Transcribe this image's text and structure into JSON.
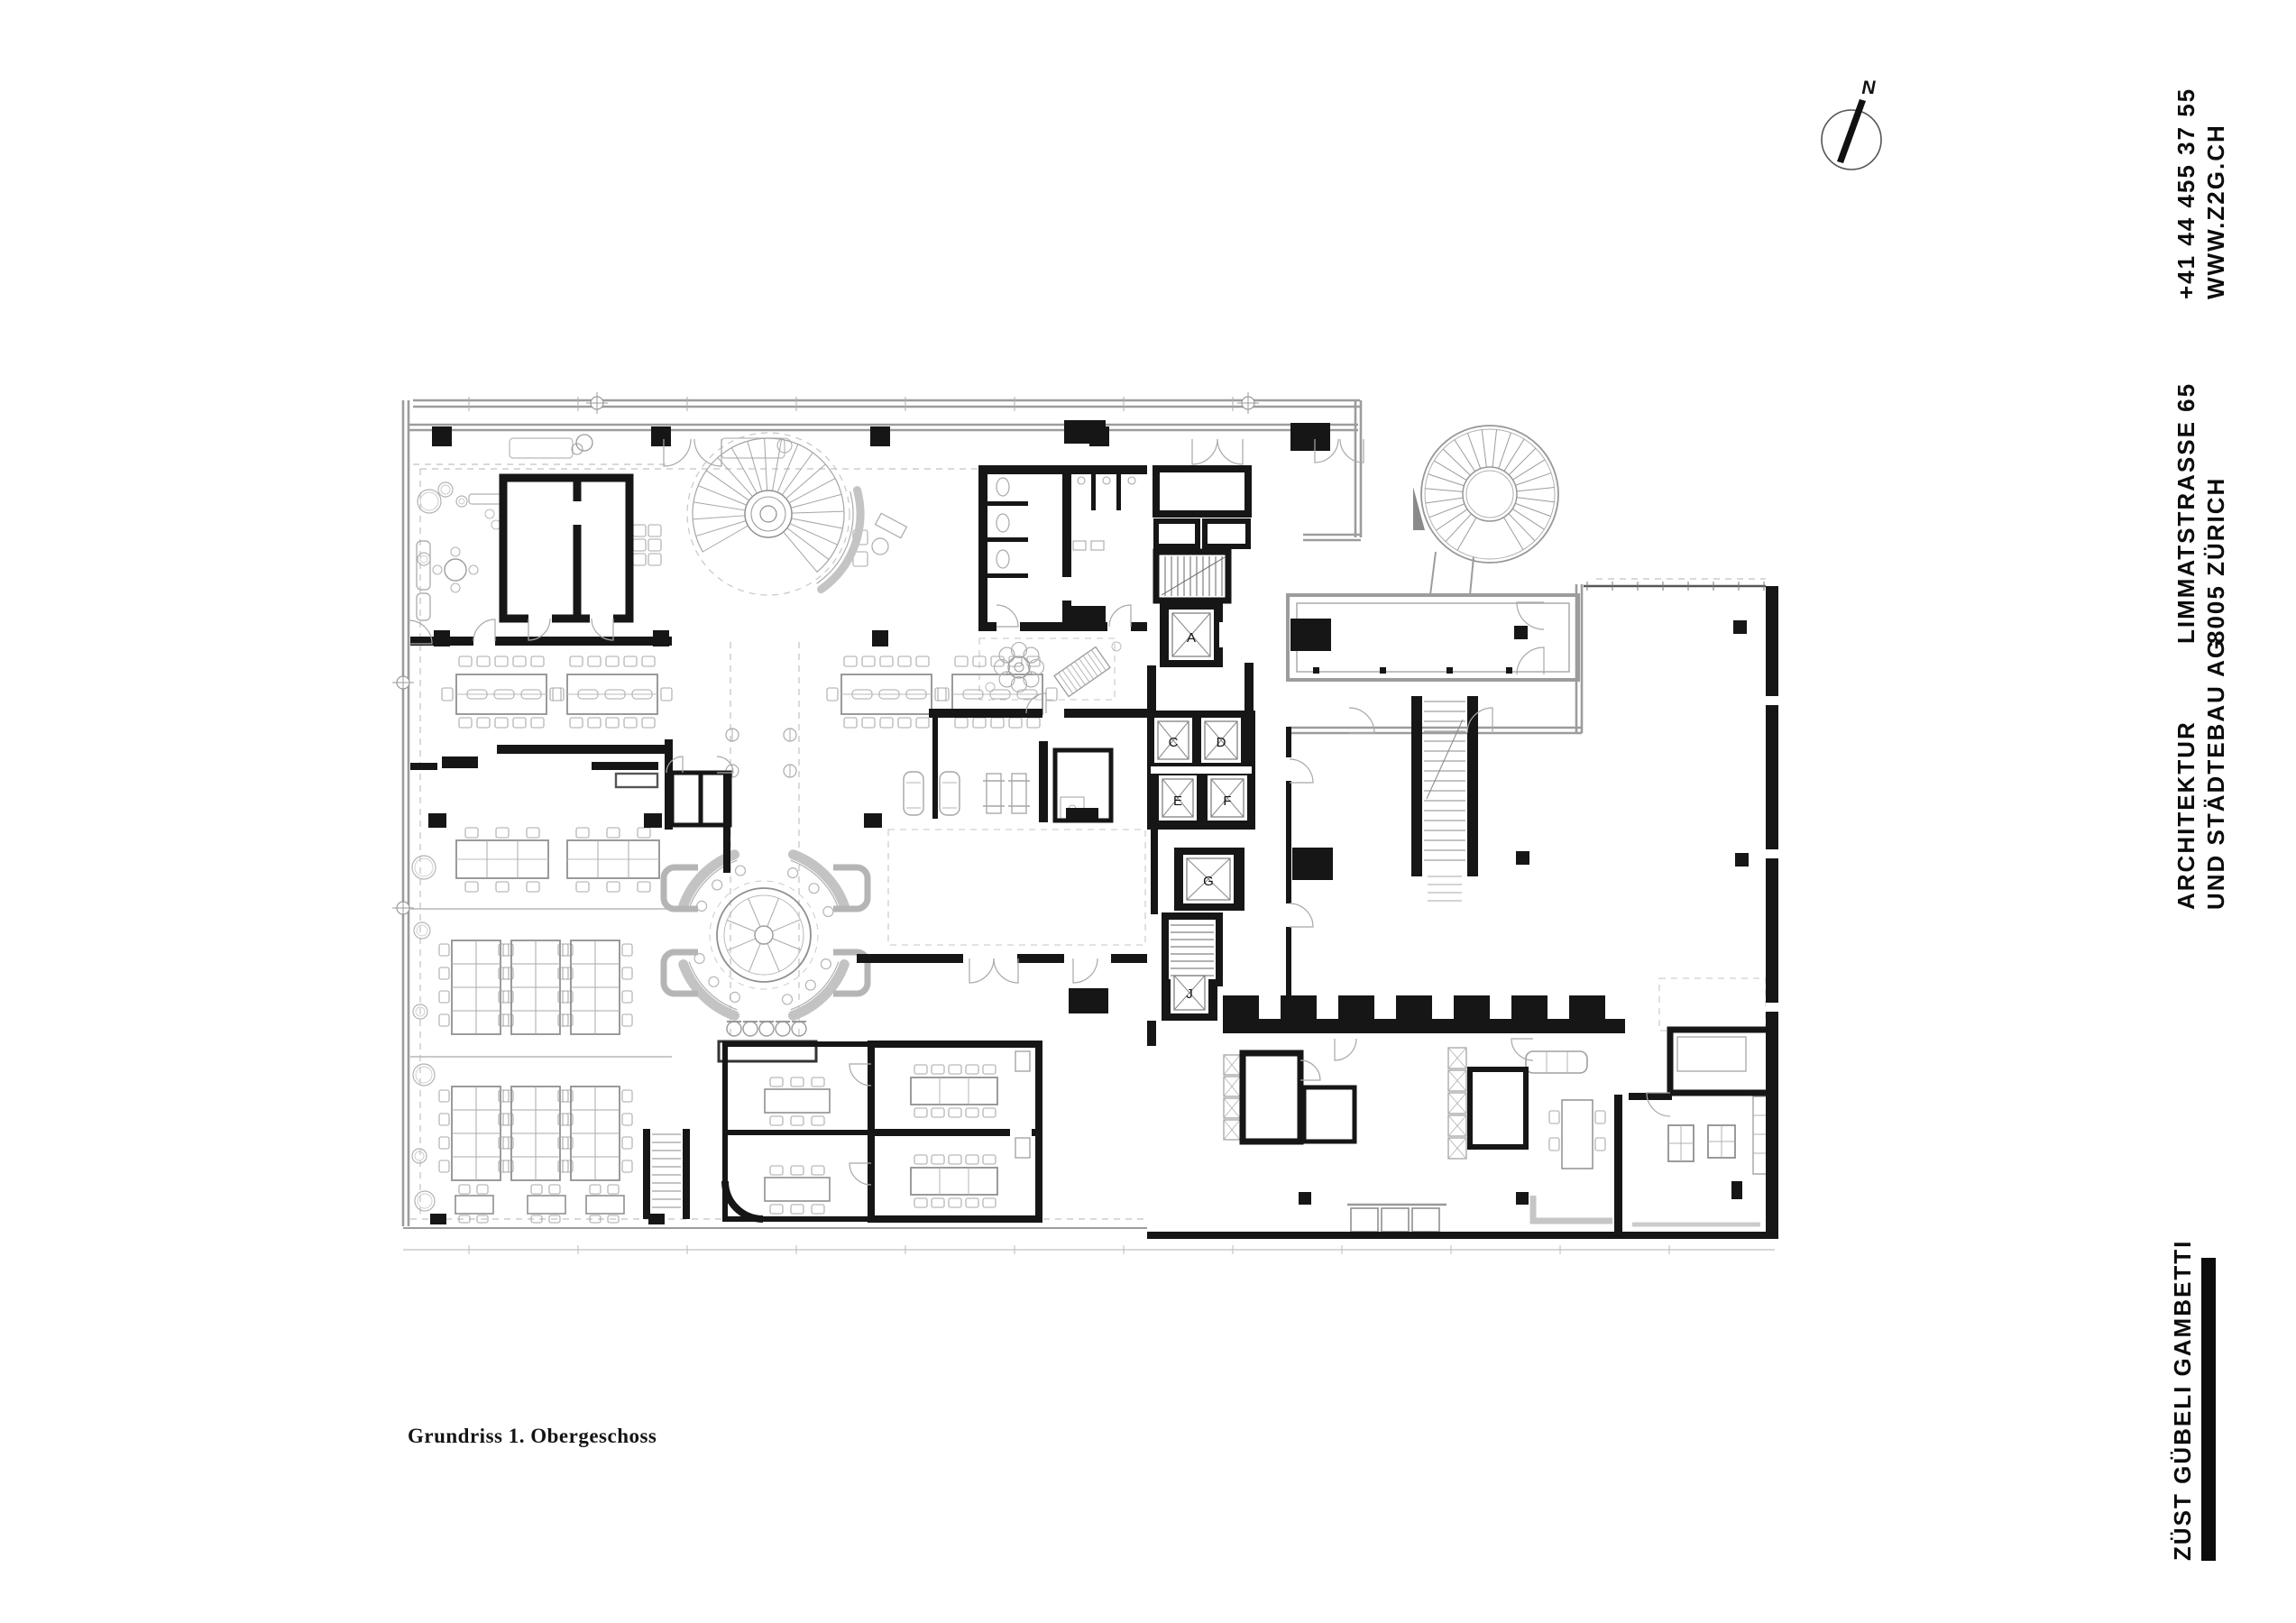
{
  "page": {
    "background": "#ffffff"
  },
  "plan": {
    "ink": "#161616",
    "furniture_gray": "#b9b9b9",
    "facade_gray": "#9c9c9c",
    "caption": "Grundriss 1. Obergeschoss",
    "elevator_labels": [
      "A",
      "C",
      "D",
      "E",
      "F",
      "G",
      "J"
    ]
  },
  "north_arrow": {
    "label": "N"
  },
  "sidebar_blocks": {
    "contact": {
      "line1": "+41 44 455 37 55",
      "line2": "WWW.Z2G.CH"
    },
    "address": {
      "line1": "LIMMATSTRASSE 65",
      "line2": "8005 ZÜRICH"
    },
    "firm": {
      "line1": "ARCHITEKTUR",
      "line2": "UND STÄDTEBAU AG"
    },
    "brand": {
      "label": "ZÜST GÜBELI GAMBETTI"
    }
  }
}
